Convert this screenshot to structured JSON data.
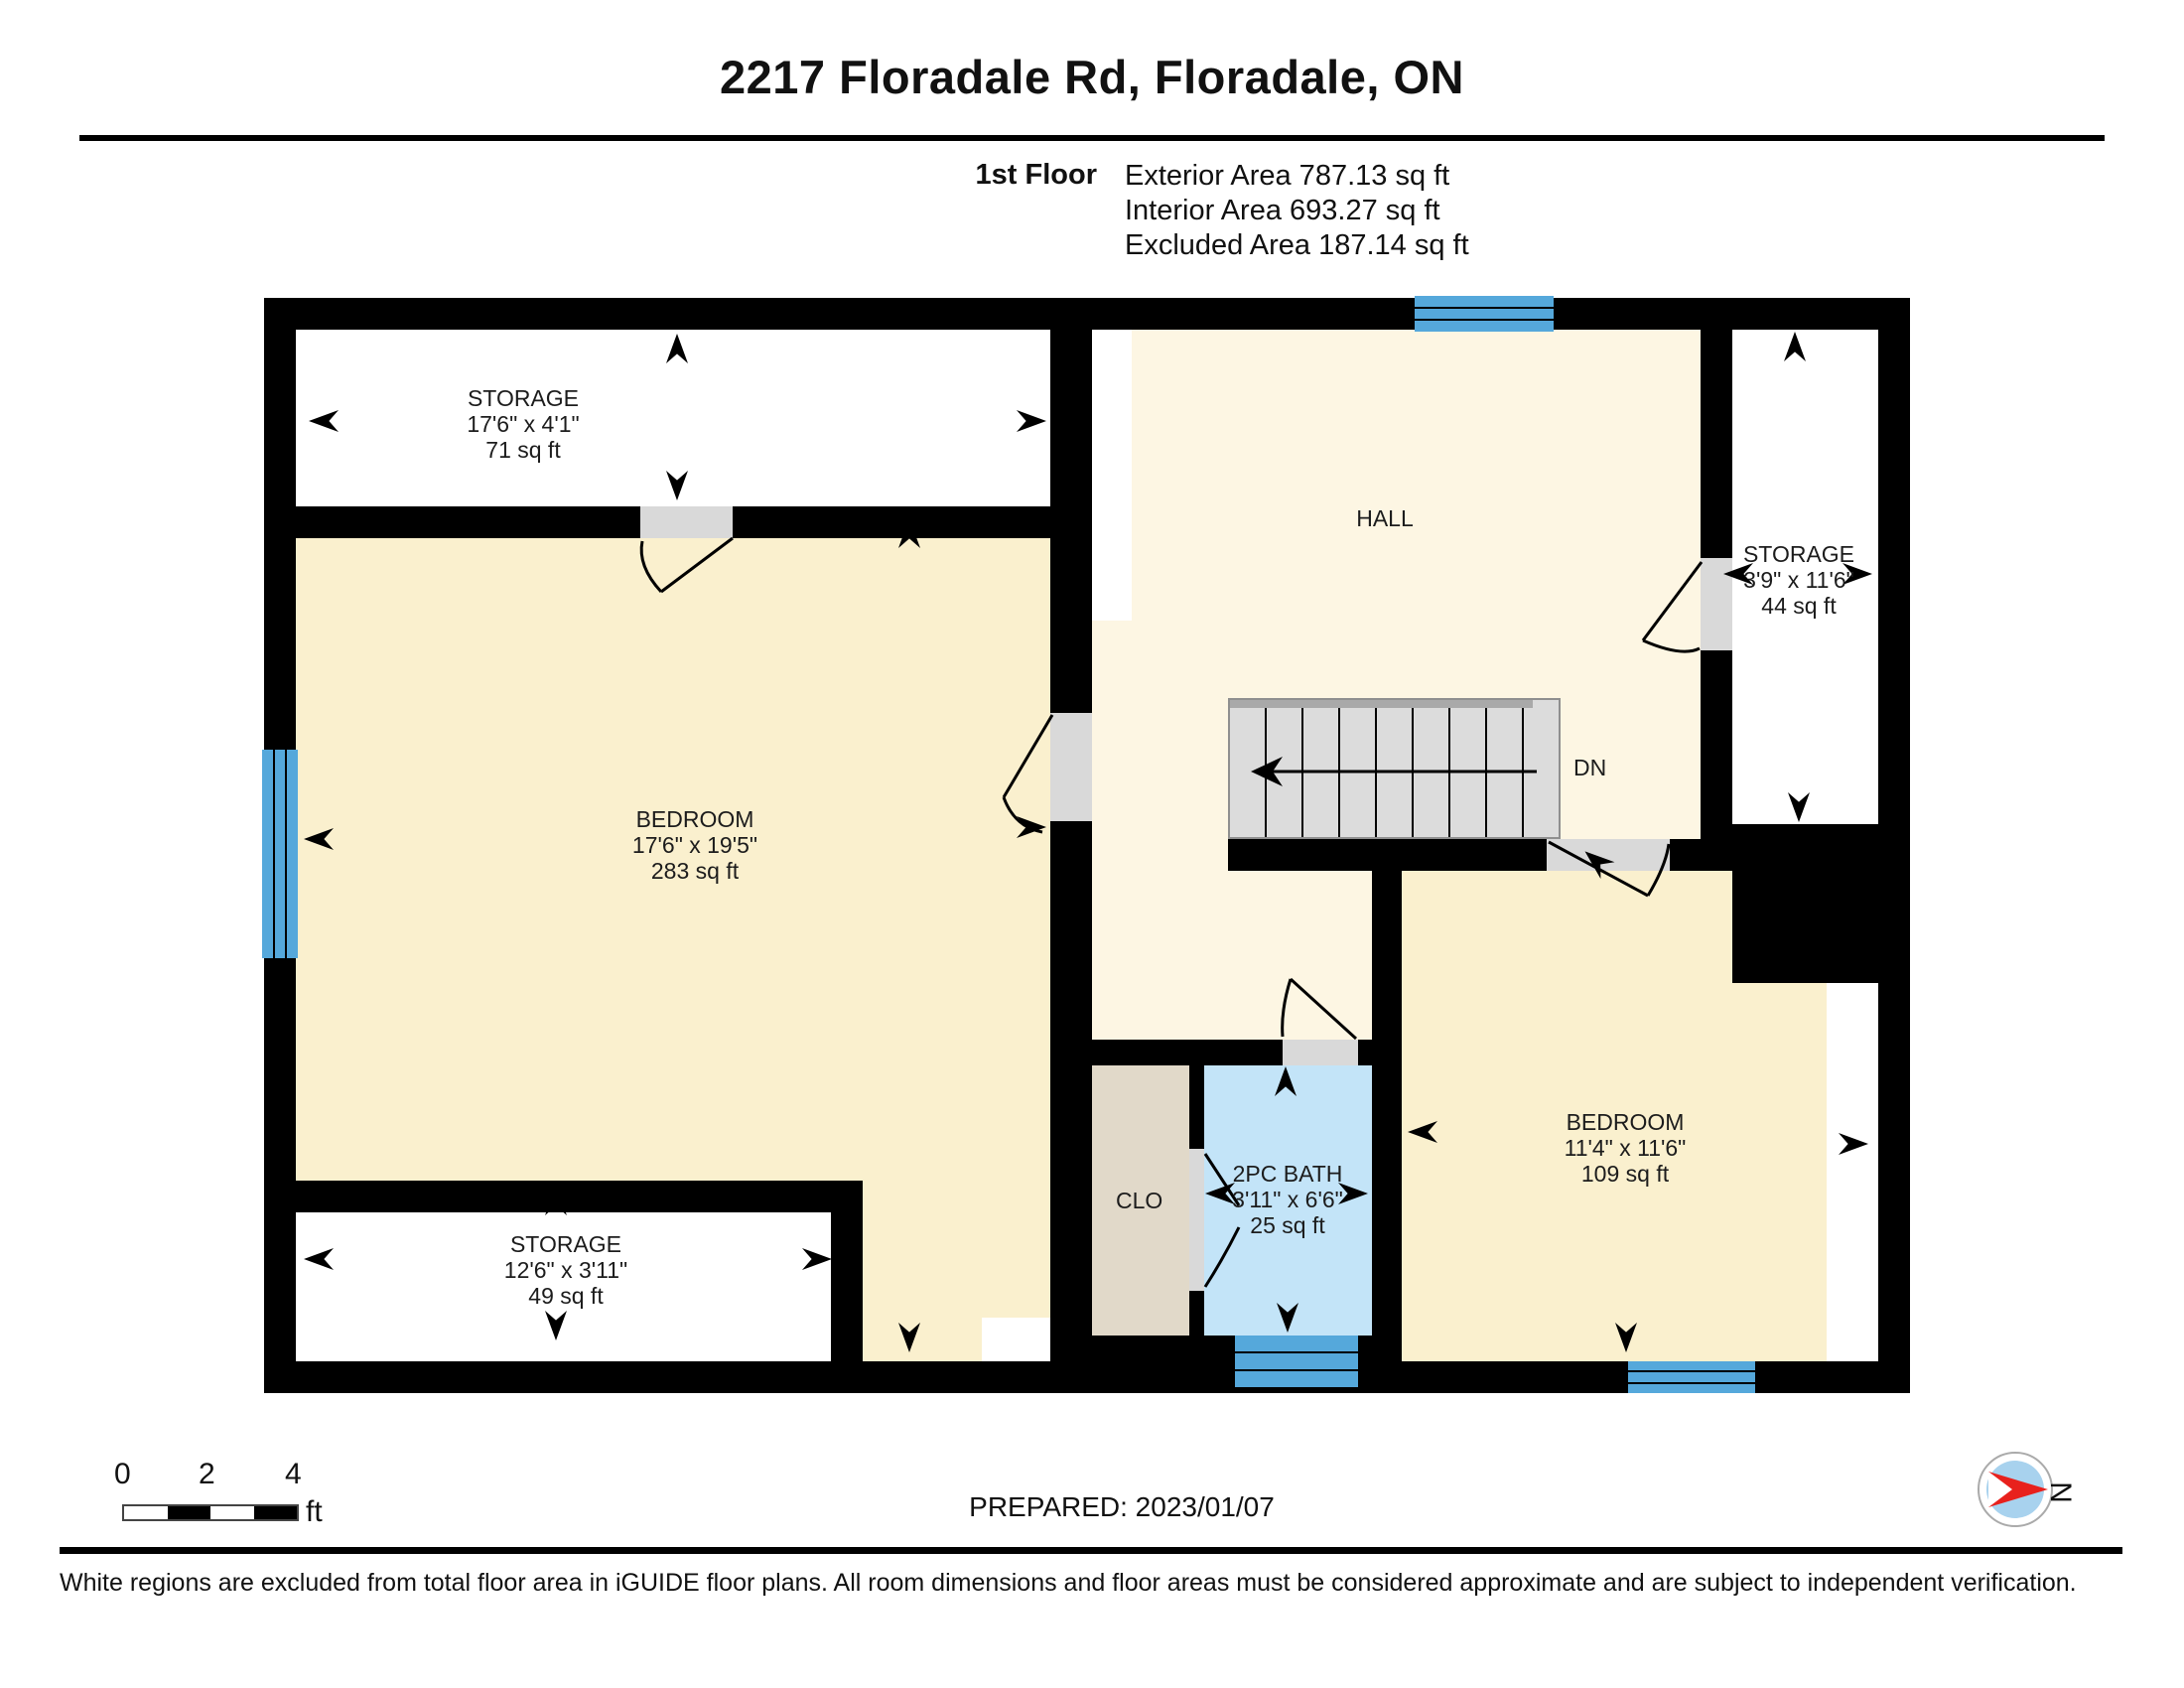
{
  "header": {
    "title": "2217 Floradale Rd, Floradale, ON",
    "floor_label": "1st Floor",
    "exterior_area": "Exterior Area 787.13 sq ft",
    "interior_area": "Interior Area 693.27 sq ft",
    "excluded_area": "Excluded Area 187.14 sq ft"
  },
  "rooms": [
    {
      "name": "STORAGE",
      "dims": "17'6\" x 4'1\"",
      "area": "71 sq ft"
    },
    {
      "name": "BEDROOM",
      "dims": "17'6\" x 19'5\"",
      "area": "283 sq ft"
    },
    {
      "name": "STORAGE",
      "dims": "12'6\" x 3'11\"",
      "area": "49 sq ft"
    },
    {
      "name": "HALL"
    },
    {
      "name": "STORAGE",
      "dims": "3'9\" x 11'6\"",
      "area": "44 sq ft"
    },
    {
      "name": "BEDROOM",
      "dims": "11'4\" x 11'6\"",
      "area": "109 sq ft"
    },
    {
      "name": "2PC BATH",
      "dims": "3'11\" x 6'6\"",
      "area": "25 sq ft"
    },
    {
      "name": "CLO"
    }
  ],
  "stairs": {
    "label": "DN"
  },
  "scale_bar": {
    "tick0": "0",
    "tick1": "2",
    "tick2": "4",
    "unit": "ft"
  },
  "prepared": "PREPARED: 2023/01/07",
  "compass": {
    "label": "N"
  },
  "disclaimer": "White regions are excluded from total floor area in iGUIDE floor plans. All room dimensions and floor areas must be considered approximate and are subject to independent verification.",
  "colors": {
    "wall": "#000000",
    "bedroom_fill": "#FAF0CE",
    "hall_fill": "#FDF6E3",
    "excluded_fill": "#FFFFFF",
    "bath_fill": "#C3E4F8",
    "closet_fill": "#E1D9C9",
    "window_blue": "#55A8DB",
    "stair_gray": "#DCDCDC",
    "compass_red": "#E8211D"
  }
}
